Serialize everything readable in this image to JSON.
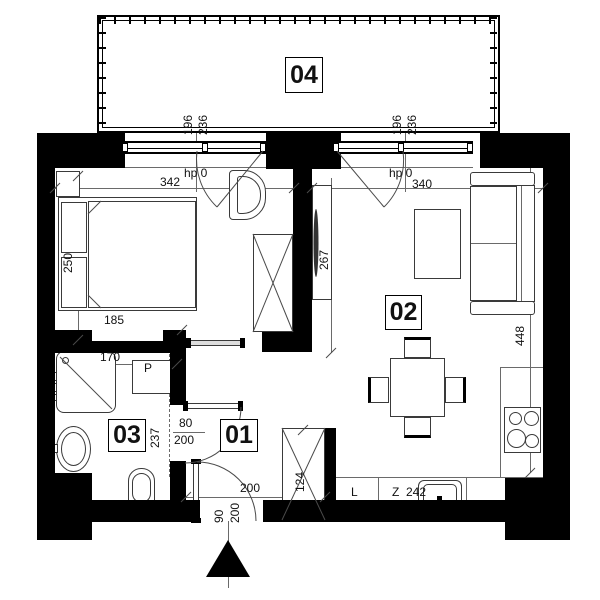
{
  "rooms": {
    "hall": {
      "number": "01"
    },
    "living": {
      "number": "02"
    },
    "bath": {
      "number": "03"
    },
    "balcony": {
      "number": "04"
    }
  },
  "dims": {
    "win_l_w": "196",
    "win_l_h": "236",
    "win_r_w": "196",
    "win_r_h": "236",
    "bedroom_w": "342",
    "living_w": "340",
    "hp_l": "hp 0",
    "hp_r": "hp 0",
    "bed_len": "250",
    "bed_wid": "185",
    "tv_wall": "267",
    "living_d": "448",
    "bath_w": "170",
    "bath_d": "237",
    "bath_door_w": "80",
    "bath_door_h": "200",
    "hall_w": "200",
    "entry_w": "90",
    "entry_h": "200",
    "wardrobe_h": "124",
    "kitchen_run": "242"
  },
  "letters": {
    "washer": "P",
    "fridge": "L",
    "sink": "Z"
  }
}
